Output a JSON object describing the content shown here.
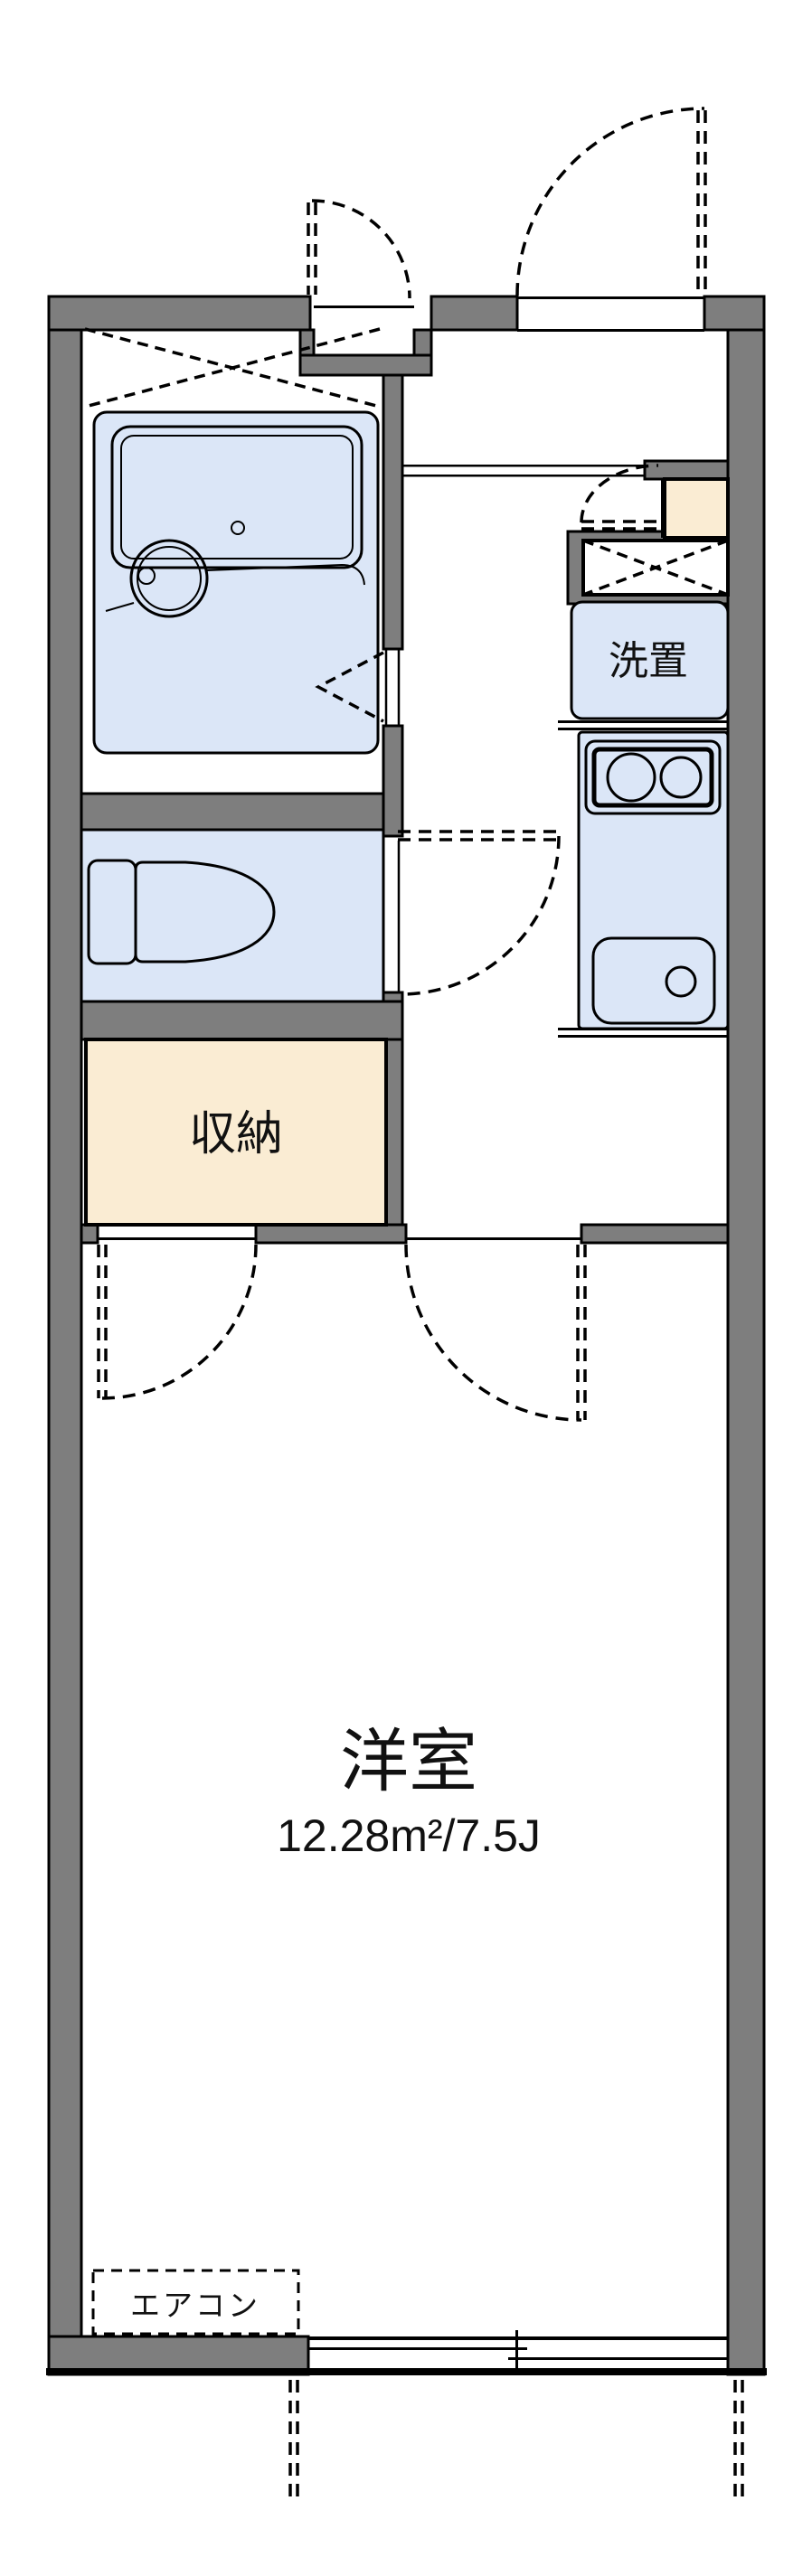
{
  "plan": {
    "rooms": {
      "washer": {
        "label": "洗置"
      },
      "storage": {
        "label": "収納"
      },
      "main": {
        "label": "洋室",
        "size": "12.28m²/7.5J"
      },
      "aircon": {
        "label": "エアコン"
      }
    },
    "colors": {
      "wall": "#7E7E7E",
      "fixture": "#DBE6F7",
      "storage": "#FAECD3",
      "line": "#000000",
      "bg": "#FFFFFF"
    }
  }
}
